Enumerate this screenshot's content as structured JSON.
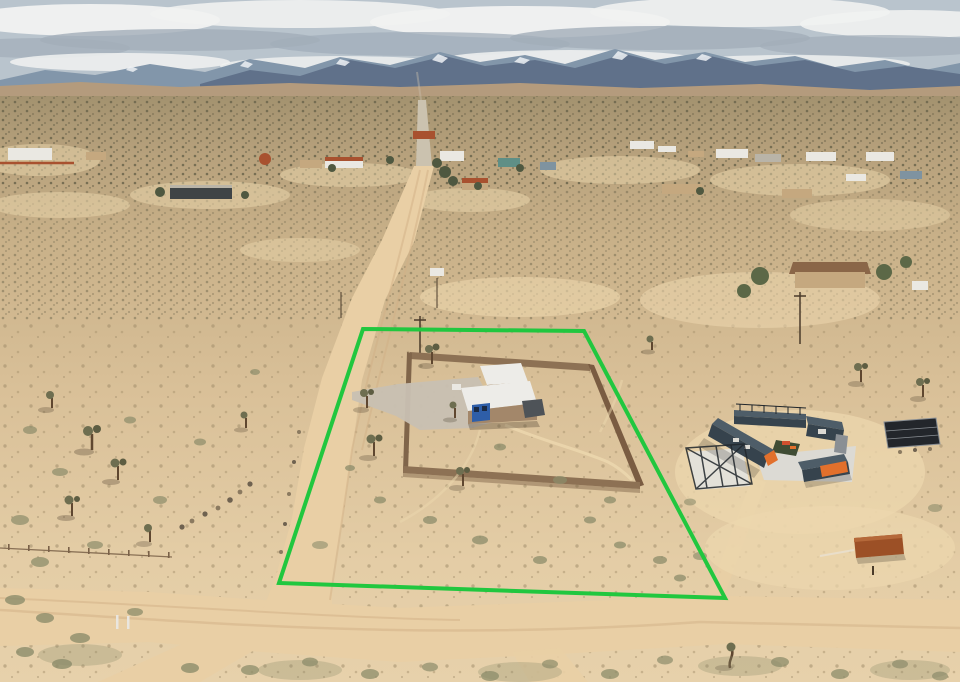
{
  "meta": {
    "title": "Aerial drone photograph of high-desert property listing",
    "description": "Overhead real-estate photo of a desert lot outlined in green, containing a small white-roofed cabin with a blue door inside a walled compound; dirt roads, Joshua trees, a shipping-container home with solar panel to the east, scattered neighborhood homes and snow-capped mountains on the horizon under a cloudy sky."
  },
  "property_boundary": {
    "points": "363,329 584,331 725,598 279,583",
    "stroke_width": 4
  },
  "features": {
    "lot": "green outlined parcel with fenced adobe-walled compound",
    "main_house": "small cabin, white roof, tan walls, blue door and window",
    "shed": "white-roofed outbuilding behind cabin",
    "neighbor_east": "U-shaped shipping-container home with white patio, orange accents, pergola and ground solar panel",
    "roads": "dirt road running north to paved section at horizon; sandy cross road along south edge",
    "background": "desert community, snow-capped mountain range, overcast sky"
  },
  "palette": {
    "sky_base": "#b9c4cd",
    "cloud_white": "#f1f2f1",
    "cloud_gray": "#a2aeb9",
    "mountain_far": "#8296aa",
    "mountain_near": "#60718a",
    "snow": "#eef1f4",
    "foothill": "#b49b7d",
    "ground_far": "#a3926f",
    "ground_mid1": "#b7a17c",
    "ground_mid2": "#c9b189",
    "ground_near": "#d9c098",
    "ground_fore": "#e4cda6",
    "ground_bottom": "#e7d1ab",
    "speck_dark": "#6f684e",
    "speck_mid": "#8a7c5e",
    "speck_warm": "#9b8866",
    "speck_soft": "#a8936e",
    "clearing": "#ecd7ae",
    "road_sand": "#e9cfa5",
    "road_worn": "#d2b187",
    "road_paved": "#cbc2af",
    "boundary_green": "#21c73f",
    "wall_tan": "#8d7154",
    "wall_dark": "#7a5c42",
    "wall_left": "#80654a",
    "wall_shadow": "#6b5138",
    "gravel": "#c8c0b2",
    "roof_white": "#edece8",
    "shed_wall": "#9a8063",
    "house_wall": "#a3876a",
    "door_blue": "#2e5ea8",
    "pane_dark": "#1a2a44",
    "canopy_dark": "#4e5358",
    "slate_top": "#4e5d68",
    "slate_side": "#36434d",
    "container_orange": "#e2702c",
    "orange_red": "#cf4f2e",
    "deck_white": "#dcdad4",
    "slab_white": "#e3e1db",
    "courtyard_green": "#3f4c34",
    "frame_dark": "#20262b",
    "solar_dark": "#23262b",
    "solar_frame": "#8a8f94",
    "rust": "#9c5026",
    "rust_light": "#b5693a",
    "house_white": "#eae8e2",
    "house_tan": "#c5a87f",
    "house_gray": "#b9b4a8",
    "house_dark": "#3f4446",
    "house_slate": "#7f93a0",
    "roof_red": "#a8512f",
    "roof_teal": "#5f8f86",
    "roof_brown": "#8a6648",
    "tree_green": "#5c6847",
    "tree_dark": "#4f5840",
    "josh_olive": "#6e6e50",
    "josh_dark": "#5d5d42",
    "trunk": "#5f4730",
    "scrub_olive": "#8c8c6a",
    "scrub_gray": "#97977c",
    "rock": "#8b7a60",
    "rock_dark": "#6f6250",
    "fence": "#7a6148",
    "post_white": "#e9e6df",
    "pole": "#4a3b2a",
    "shadow": "#3c2f20"
  }
}
